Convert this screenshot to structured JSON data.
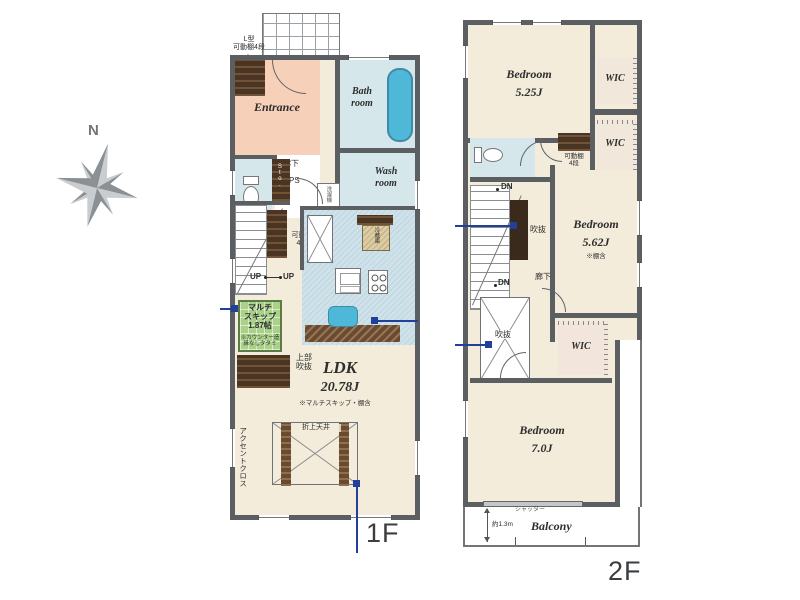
{
  "palette": {
    "wall": "#5b5f62",
    "room_cream": "#f3ecdb",
    "room_blue": "#d6e7ec",
    "tub_blue": "#4fb8d9",
    "entrance_peach": "#f7d0ba",
    "skip_green": "#a9d288",
    "wood_dark": "#4a3424",
    "kitchen_blue": "#cfe2ea",
    "marker_navy": "#20409a",
    "compass_gray": "#8a9094"
  },
  "compass": {
    "north": "N"
  },
  "f1": {
    "floor_label": "1F",
    "l_shelf_note": {
      "l1": "L型",
      "l2": "可動棚4段"
    },
    "entrance": "Entrance",
    "bath": {
      "l1": "Bath",
      "l2": "room"
    },
    "hall": "廊下",
    "ps": "PS",
    "sto": "Sto.",
    "washer": "洗濯機",
    "wash": {
      "l1": "Wash",
      "l2": "room"
    },
    "stair_shelf": {
      "l1": "可動棚",
      "l2": "4段"
    },
    "up1": "UP",
    "up2": "UP",
    "multi": {
      "l1": "マルチ",
      "l2": "スキップ",
      "l3": "1.87帖",
      "n1": "※カウンター造",
      "n2": "縁なしタタミ"
    },
    "upper_void": {
      "l1": "上部",
      "l2": "吹抜"
    },
    "ldk": {
      "name": "LDK",
      "size": "20.78J",
      "note": "※マルチスキップ・棚含"
    },
    "ceiling": "折上天井",
    "accent": "アクセントクロス",
    "fridge": "冷蔵庫"
  },
  "f2": {
    "floor_label": "2F",
    "bed1": {
      "name": "Bedroom",
      "size": "5.25J"
    },
    "wic1": "WIC",
    "wic2": "WIC",
    "wic3": "WIC",
    "shelf": {
      "l1": "可動棚",
      "l2": "4段"
    },
    "dn1": "DN",
    "dn2": "DN",
    "void1": "吹抜",
    "void2": "吹抜",
    "hall": "廊下",
    "bed2": {
      "name": "Bedroom",
      "size": "5.62J",
      "note": "※棚含"
    },
    "bed3": {
      "name": "Bedroom",
      "size": "7.0J"
    },
    "shutter": "シャッター",
    "balcony": {
      "name": "Balcony",
      "depth": "約1.3m"
    }
  }
}
